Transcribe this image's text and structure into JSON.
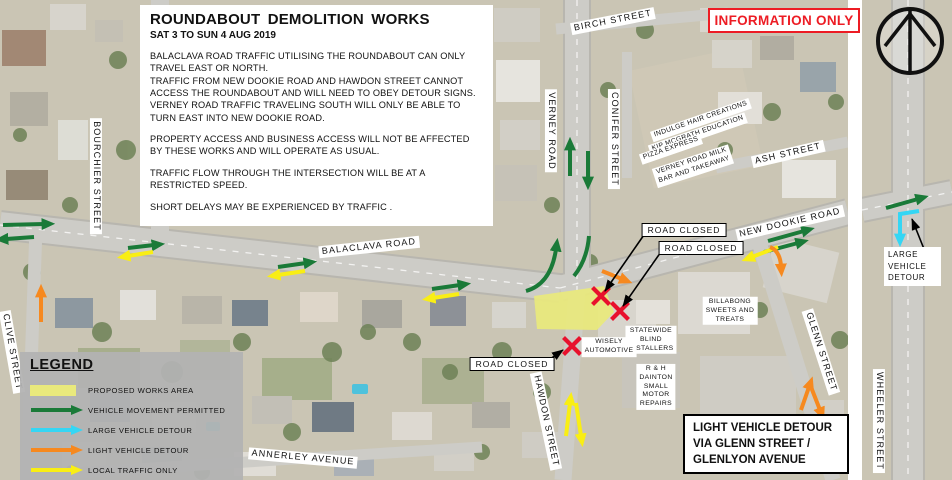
{
  "title_block": {
    "title": "ROUNDABOUT  DEMOLITION WORKS",
    "date_range": "SAT 3 TO SUN 4 AUG 2019",
    "paragraphs": [
      "BALACLAVA ROAD TRAFFIC UTILISING THE ROUNDABOUT CAN ONLY\nTRAVEL EAST OR NORTH.\nTRAFFIC FROM NEW DOOKIE ROAD AND HAWDON STREET CANNOT\nACCESS THE ROUNDABOUT AND WILL NEED TO OBEY DETOUR SIGNS.\nVERNEY ROAD TRAFFIC TRAVELING SOUTH WILL ONLY BE ABLE TO\nTURN EAST INTO NEW DOOKIE ROAD.",
      "PROPERTY ACCESS AND BUSINESS ACCESS WILL NOT BE AFFECTED\nBY THESE WORKS AND WILL OPERATE AS USUAL.",
      "TRAFFIC FLOW THROUGH THE INTERSECTION WILL BE AT A\nRESTRICTED SPEED.",
      "SHORT DELAYS MAY BE EXPERIENCED BY TRAFFIC ."
    ]
  },
  "info_banner": {
    "label": "INFORMATION ONLY"
  },
  "streets": {
    "bourchier": "BOURCHIER STREET",
    "clive": "CLIVE STREET",
    "birch": "BIRCH STREET",
    "verney": "VERNEY ROAD",
    "conifer": "CONIFER STREET",
    "ash": "ASH STREET",
    "new_dookie": "NEW DOOKIE ROAD",
    "balaclava": "BALACLAVA ROAD",
    "glenn": "GLENN STREET",
    "hawdon": "HAWDON STREET",
    "wheeler": "WHEELER STREET",
    "annerley": "ANNERLEY AVENUE"
  },
  "businesses": {
    "indulge": "INDULGE HAIR CREATIONS",
    "kip_mcgrath": "KIP MCGRATH EDUCATION",
    "pizza_express": "PIZZA EXPRESS",
    "verney_milk": "VERNEY ROAD MILK\nBAR AND TAKEAWAY",
    "billabong": "BILLABONG\nSWEETS AND\nTREATS",
    "statewide": "STATEWIDE\nBLIND\nINSTALLERS",
    "dainton": "R & H\nDAINTON\nSMALL\nMOTOR\nREPAIRS",
    "wisely": "WISELY\nAUTOMOTIVE"
  },
  "callouts": {
    "road_closed": "ROAD CLOSED",
    "large_vehicle_detour": "LARGE\nVEHICLE\nDETOUR",
    "light_vehicle_detour": "LIGHT VEHICLE DETOUR\nVIA GLENN STREET /\nGLENLYON AVENUE"
  },
  "legend": {
    "title": "LEGEND",
    "items": [
      {
        "label": "PROPOSED WORKS AREA",
        "symbol": "works-area-swatch",
        "color": "#e9e97c"
      },
      {
        "label": "VEHICLE MOVEMENT PERMITTED",
        "symbol": "green-arrow",
        "color": "#1a7a38"
      },
      {
        "label": "LARGE VEHICLE DETOUR",
        "symbol": "cyan-arrow",
        "color": "#35d6f4"
      },
      {
        "label": "LIGHT VEHICLE DETOUR",
        "symbol": "orange-arrow",
        "color": "#f6891f"
      },
      {
        "label": "LOCAL TRAFFIC ONLY",
        "symbol": "yellow-arrow",
        "color": "#f9ee14"
      }
    ]
  },
  "colors": {
    "info_red": "#ed1c24",
    "road_closed_x": "#e8112d",
    "works_area": "#e9e97c",
    "movement_green": "#1a7a38",
    "large_detour_cyan": "#35d6f4",
    "light_detour_orange": "#f6891f",
    "local_traffic_yellow": "#f9ee14"
  }
}
